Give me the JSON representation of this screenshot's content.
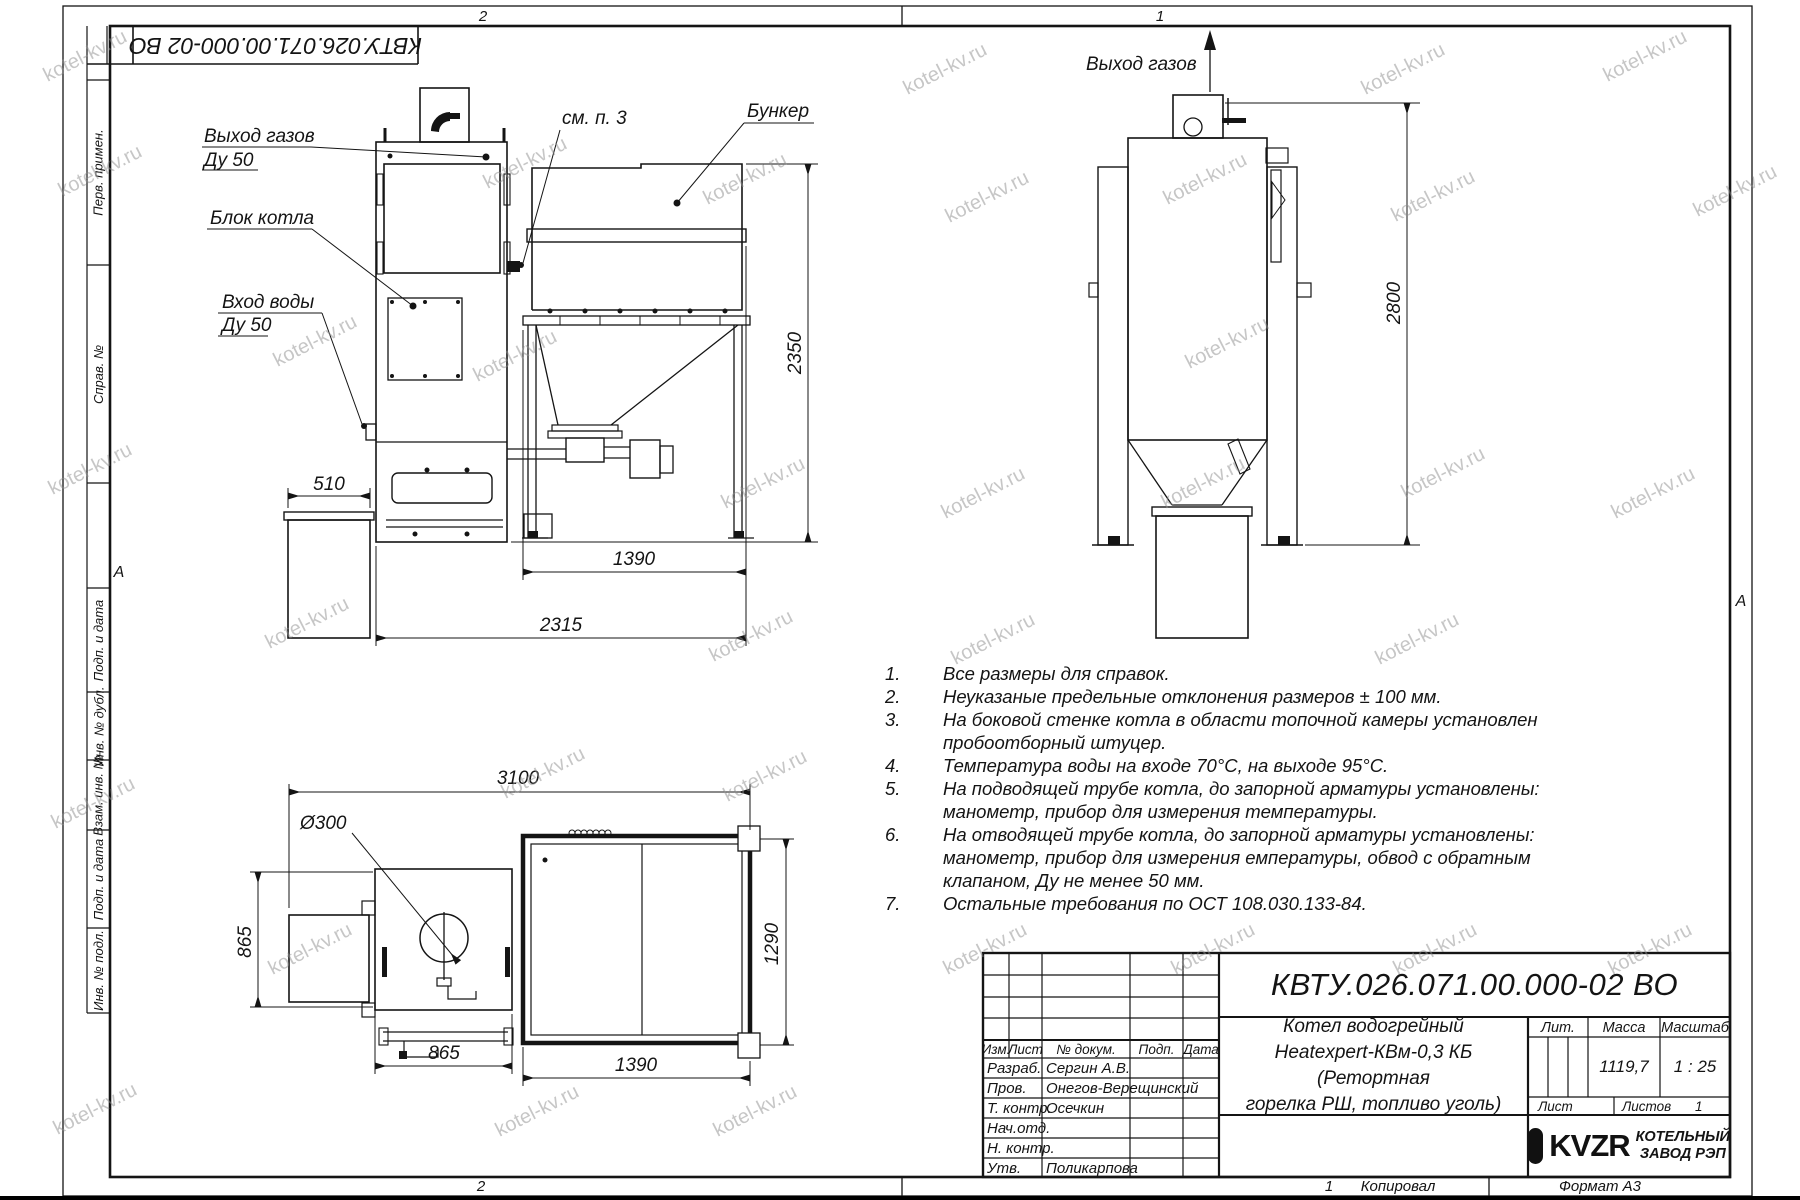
{
  "watermark": "kotel-kv.ru",
  "sheet": {
    "doc_number_inverted": "КВТУ.026.071.00.000-02 ВО",
    "zone_top_left": "2",
    "zone_top_right": "1",
    "zone_bottom_left": "2",
    "zone_bottom_num": "1",
    "copied_label": "Копировал",
    "format_label": "Формат А3",
    "zone_letter": "А",
    "margin_labels": [
      "Перв. примен.",
      "Справ. №",
      "Подп. и дата",
      "Инв. № дубл.",
      "Взам. инв. №",
      "Подп. и дата",
      "Инв. № подл."
    ]
  },
  "views": {
    "front": {
      "gas_out": "Выход газов",
      "gas_out_dn": "Ду 50",
      "boiler_block": "Блок котла",
      "water_in": "Вход воды",
      "water_in_dn": "Ду 50",
      "see_note": "см. п. 3",
      "bunker": "Бункер",
      "dim_510": "510",
      "dim_1390": "1390",
      "dim_2315": "2315",
      "dim_2350": "2350"
    },
    "side": {
      "gas_out": "Выход газов",
      "dim_2800": "2800"
    },
    "plan": {
      "dia": "Ø300",
      "dim_3100": "3100",
      "dim_865_v": "865",
      "dim_865_h": "865",
      "dim_1390": "1390",
      "dim_1290": "1290"
    }
  },
  "notes": [
    {
      "num": "1.",
      "text": "Все размеры для справок."
    },
    {
      "num": "2.",
      "text": "Неуказаные предельные отклонения размеров ± 100 мм."
    },
    {
      "num": "3.",
      "text": "На боковой стенке котла в области топочной камеры установлен\nпробоотборный штуцер."
    },
    {
      "num": "4.",
      "text": "Температура воды на входе 70°С, на выходе 95°С."
    },
    {
      "num": "5.",
      "text": "На подводящей трубе котла, до запорной арматуры установлены:\nманометр, прибор для измерения температуры."
    },
    {
      "num": "6.",
      "text": "На отводящей трубе котла, до запорной арматуры установлены:\nманометр, прибор для измерения емпературы, обвод с обратным\nклапаном, Ду не менее 50 мм."
    },
    {
      "num": "7.",
      "text": "Остальные требования по ОСТ 108.030.133-84."
    }
  ],
  "title_block": {
    "doc_number": "КВТУ.026.071.00.000-02 ВО",
    "name_lines": [
      "Котел водогрейный",
      "Heatexpert-КВм-0,3 КБ (Ретортная",
      "горелка РШ, топливо уголь)"
    ],
    "header": {
      "izm": "Изм.",
      "list": "Лист",
      "doc": "№ докум.",
      "podp": "Подп.",
      "data": "Дата"
    },
    "rows": [
      {
        "role": "Разраб.",
        "name": "Сергин А.В."
      },
      {
        "role": "Пров.",
        "name": "Онегов-Верещинский"
      },
      {
        "role": "Т. контр.",
        "name": "Осечкин"
      },
      {
        "role": "Нач.отд.",
        "name": ""
      },
      {
        "role": "Н. контр.",
        "name": ""
      },
      {
        "role": "Утв.",
        "name": "Поликарпова"
      }
    ],
    "lit_label": "Лит.",
    "mass_label": "Масса",
    "scale_label": "Масштаб",
    "mass": "1119,7",
    "scale": "1 : 25",
    "sheet_label": "Лист",
    "sheets_label": "Листов",
    "sheets_value": "1",
    "logo_text": "KVZR",
    "org_lines": [
      "КОТЕЛЬНЫЙ",
      "ЗАВОД РЭП"
    ]
  }
}
